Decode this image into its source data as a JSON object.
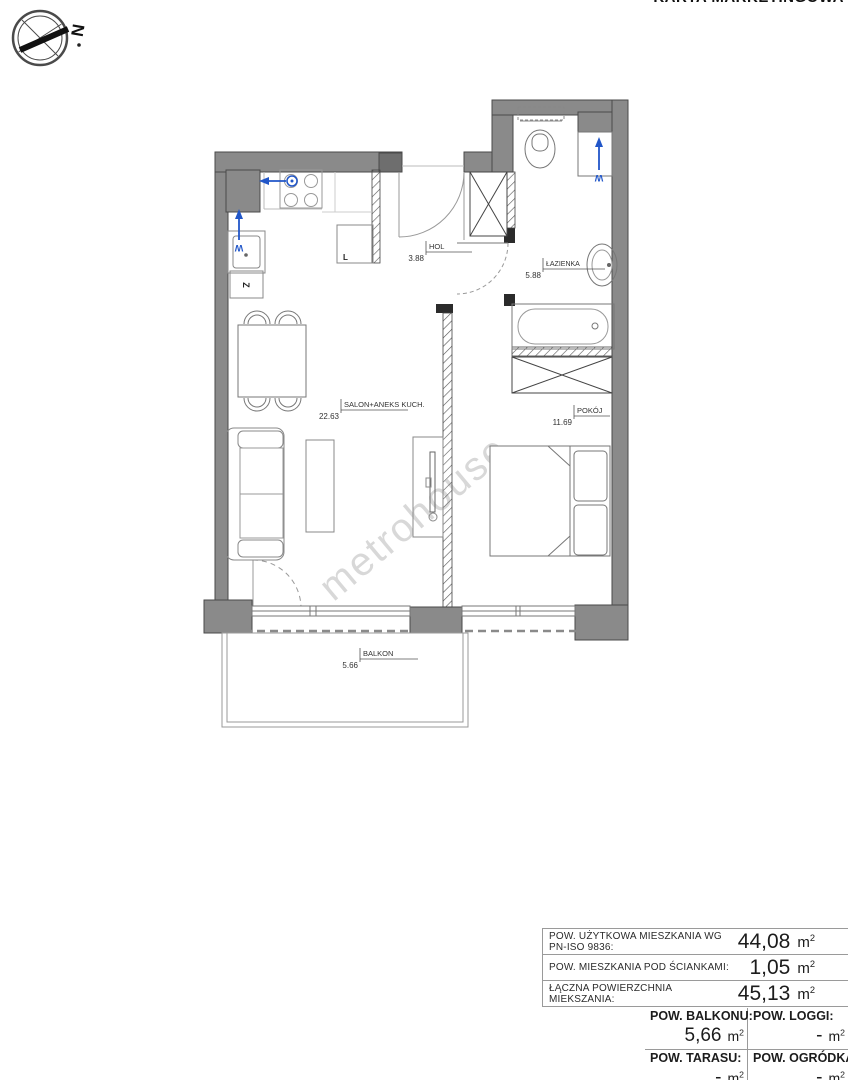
{
  "page": {
    "title": "KARTA MARKETINGOWA"
  },
  "compass": {
    "north": "N"
  },
  "watermark": {
    "text": "metrohouse"
  },
  "plan": {
    "rooms": [
      {
        "name": "HOL",
        "area": "3.88"
      },
      {
        "name": "ŁAZIENKA",
        "area": "5.88"
      },
      {
        "name": "SALON+ANEKS KUCH.",
        "area": "22.63"
      },
      {
        "name": "POKÓJ",
        "area": "11.69"
      },
      {
        "name": "BALKON",
        "area": "5.66"
      }
    ],
    "markers": {
      "kitchen_water": "W",
      "kitchen_drain": "Z",
      "fridge": "L",
      "washer_water": "W"
    }
  },
  "summary": {
    "rows": [
      {
        "label": "POW. UŻYTKOWA MIESZKANIA WG PN-ISO 9836:",
        "value": "44,08"
      },
      {
        "label": "POW. MIESZKANIA POD ŚCIANKAMI:",
        "value": "1,05"
      },
      {
        "label": "ŁĄCZNA POWIERZCHNIA MIEKSZANIA:",
        "value": "45,13"
      }
    ],
    "grid": [
      {
        "label": "POW. BALKONU:",
        "value": "5,66"
      },
      {
        "label": "POW. LOGGI:",
        "value": "-"
      },
      {
        "label": "POW. TARASU:",
        "value": "-"
      },
      {
        "label": "POW. OGRÓDKA:",
        "value": "-"
      }
    ],
    "unit_base": "m",
    "unit_sup": "2"
  },
  "colors": {
    "wall_gray": "#8a8a8a",
    "accent_blue": "#2156c8",
    "watermark_gray": "#c4c4c4"
  }
}
